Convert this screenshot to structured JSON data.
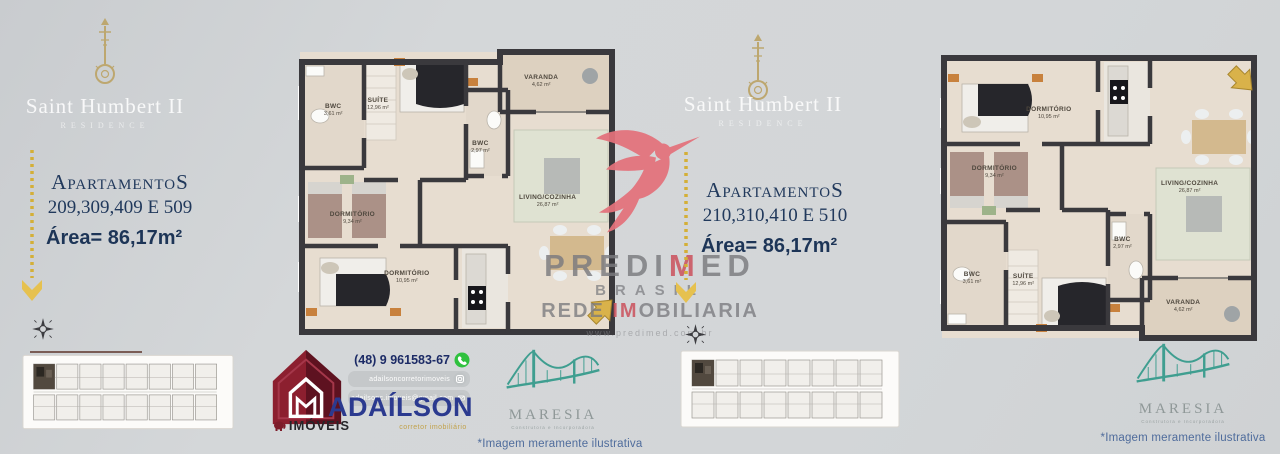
{
  "colors": {
    "navy": "#1d3557",
    "gold": "#d4af37",
    "brand_red": "#cb545f",
    "maroon": "#7d1c2a",
    "teal": "#3f9e90",
    "agent_blue": "#2b3a8f"
  },
  "panels": {
    "left": {
      "title": "Saint Humbert II",
      "subtitle": "RESIDENCE",
      "label": "ApartamentoS",
      "units": "209,309,409 E 509",
      "area": "Área= 86,17m²"
    },
    "right": {
      "title": "Saint Humbert II",
      "subtitle": "RESIDENCE",
      "label": "ApartamentoS",
      "units": "210,310,410 E 510",
      "area": "Área= 86,17m²"
    }
  },
  "watermark": {
    "brand": {
      "pre": "PREDI",
      "accent": "M",
      "post": "ED"
    },
    "line2": "BRASIL",
    "line3": {
      "pre": "REDE ",
      "accent": "IM",
      "post": "OBILIARIA"
    },
    "url": "www.predimed.com.br"
  },
  "floorplans": {
    "left": {
      "rooms": [
        {
          "name": "BWC",
          "area": "3,61 m²",
          "x": 11,
          "y": 21
        },
        {
          "name": "SUÍTE",
          "area": "12,96 m²",
          "x": 25,
          "y": 19
        },
        {
          "name": "BWC",
          "area": "2,97 m²",
          "x": 57,
          "y": 34
        },
        {
          "name": "VARANDA",
          "area": "4,62 m²",
          "x": 76,
          "y": 11
        },
        {
          "name": "LIVING/COZINHA",
          "area": "26,87 m²",
          "x": 78,
          "y": 53
        },
        {
          "name": "DORMITÓRIO",
          "area": "9,34 m²",
          "x": 17,
          "y": 59
        },
        {
          "name": "DORMITÓRIO",
          "area": "10,95 m²",
          "x": 34,
          "y": 80
        }
      ]
    },
    "right": {
      "rooms": [
        {
          "name": "DORMITÓRIO",
          "area": "10,95 m²",
          "x": 34,
          "y": 20
        },
        {
          "name": "DORMITÓRIO",
          "area": "9,34 m²",
          "x": 17,
          "y": 41
        },
        {
          "name": "SUÍTE",
          "area": "12,96 m²",
          "x": 26,
          "y": 79
        },
        {
          "name": "BWC",
          "area": "3,61 m²",
          "x": 10,
          "y": 78
        },
        {
          "name": "BWC",
          "area": "2,97 m²",
          "x": 57,
          "y": 66
        },
        {
          "name": "VARANDA",
          "area": "4,62 m²",
          "x": 76,
          "y": 88
        },
        {
          "name": "LIVING/COZINHA",
          "area": "26,87 m²",
          "x": 78,
          "y": 46
        }
      ]
    }
  },
  "footer": {
    "phone": "(48) 9 961583-67",
    "instagram": "adailsoncorretorimoveis",
    "email": "adailsonc.imoveis@gmail.com",
    "agency": {
      "name": "ADAÍLSON",
      "role": "corretor imobiliário",
      "brand": "IMÓVEIS"
    },
    "maresia": {
      "name": "MARESIA",
      "tagline": "Construtora e Incorporadora"
    },
    "disclaimer": "*Imagem meramente ilustrativa"
  }
}
